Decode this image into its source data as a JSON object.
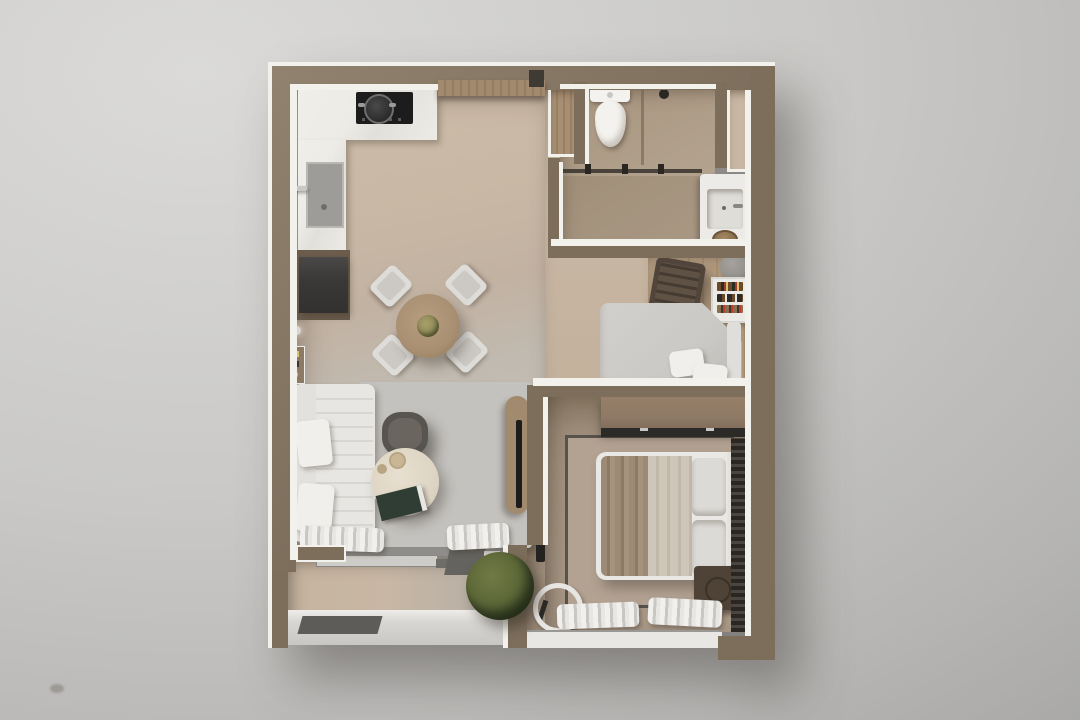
{
  "scene": {
    "title": "apartment-3d-floor-plan-render",
    "view": "top-down 3D dollhouse render on gray backdrop",
    "rooms": [
      {
        "name": "kitchen",
        "features": [
          "l-shaped-marble-counter",
          "cooktop-with-pot",
          "sink",
          "fridge-cabinet",
          "tall-cabinet-row"
        ]
      },
      {
        "name": "living-dining",
        "features": [
          "l-shaped-white-sofa",
          "two-pillows",
          "dark-armchair",
          "round-coffee-table",
          "magazine",
          "light-rug",
          "round-dining-table",
          "four-white-chairs",
          "tv-console",
          "wall-light",
          "mini-shelf"
        ]
      },
      {
        "name": "entry",
        "features": [
          "wood-plank-floor",
          "front-door"
        ]
      },
      {
        "name": "bathroom",
        "features": [
          "toilet",
          "shower-head",
          "glass-partition",
          "vanity-counter",
          "basin",
          "soap-dish",
          "service-niche"
        ]
      },
      {
        "name": "kids-nook",
        "features": [
          "daybed-with-pillows",
          "rocking-chair",
          "dome-floor-lamp",
          "bookshelf-with-books",
          "wood-floor-strip"
        ]
      },
      {
        "name": "bedroom",
        "features": [
          "double-bed",
          "beige-blanket",
          "gray-pillows",
          "headboard",
          "sliding-wardrobe",
          "dark-rug-border",
          "nightstand-with-knob",
          "round-mirror",
          "wall-tv",
          "white-window-curtains",
          "dark-side-curtain"
        ]
      },
      {
        "name": "balcony",
        "features": [
          "sliding-glass-door",
          "threshold-step",
          "green-plant",
          "white-curtains",
          "parapet-ledge"
        ]
      }
    ]
  },
  "colors": {
    "bg_light": "#dbdad8",
    "bg_dark": "#a5a4a2",
    "wall": "#7d6e5c",
    "wall_light": "#91826f",
    "trim": "#f3f1ec",
    "floor_tan": "#c8b7a4",
    "floor_gray": "#c6c3be",
    "floor_bath": "#b1a08b",
    "floor_bedroom": "#a3927f",
    "floor_wood_nook": "#b29b80",
    "entry_wood": "#a78f73",
    "cabinet_wood": "#a18a6e",
    "counter": "#edebe6",
    "cooktop": "#1c1c1c",
    "sink": "#9d9c99",
    "fridge": "#3a3937",
    "fridge_wood": "#6b5c4c",
    "sofa": "#e8e6e2",
    "sofa_rib": "#d8d6d2",
    "rug_living": "#c4c2be",
    "armchair": "#585450",
    "coffee_table": "#ded5c4",
    "magazine": "#303d34",
    "dining_table": "#a98f72",
    "chair": "#dedcd8",
    "daybed": "#cbc9c5",
    "daybed_back": "#e0deda",
    "rocking_chair": "#51453b",
    "lamp": "#94918d",
    "bookshelf": "#eceae6",
    "bed_frame": "#eae8e4",
    "blanket_dark": "#9d8a76",
    "blanket_light": "#cfc6ba",
    "pillow": "#dcdad6",
    "headboard": "#e6e4e0",
    "wardrobe": "#8e7a66",
    "track": "#2c2a27",
    "nightstand": "#4f4337",
    "knob": "#8a6e50",
    "mirror_ring": "#e8e6e2",
    "curtain_white": "#f2f0ec",
    "curtain_fold": "#c9c7c3",
    "curtain_dark": "#2a2622",
    "curtain_dark_fold": "#4a453e",
    "rug_bedroom": "#b3a292",
    "rug_border": "#57524c",
    "plant": "#5d6838",
    "plant_dark": "#3f4a2c",
    "toilet": "#f4f2ee",
    "vanity": "#edebe7",
    "basin": "#dfddd8",
    "dish": "#8a6f4e",
    "glass": "#37332e",
    "rail": "#8f8d89",
    "rail_dark": "#6f6d69",
    "threshold": "#65635f",
    "ledge": "#d8d6d3",
    "window": "#e9e7e3",
    "tv": "#1e1c1a"
  }
}
